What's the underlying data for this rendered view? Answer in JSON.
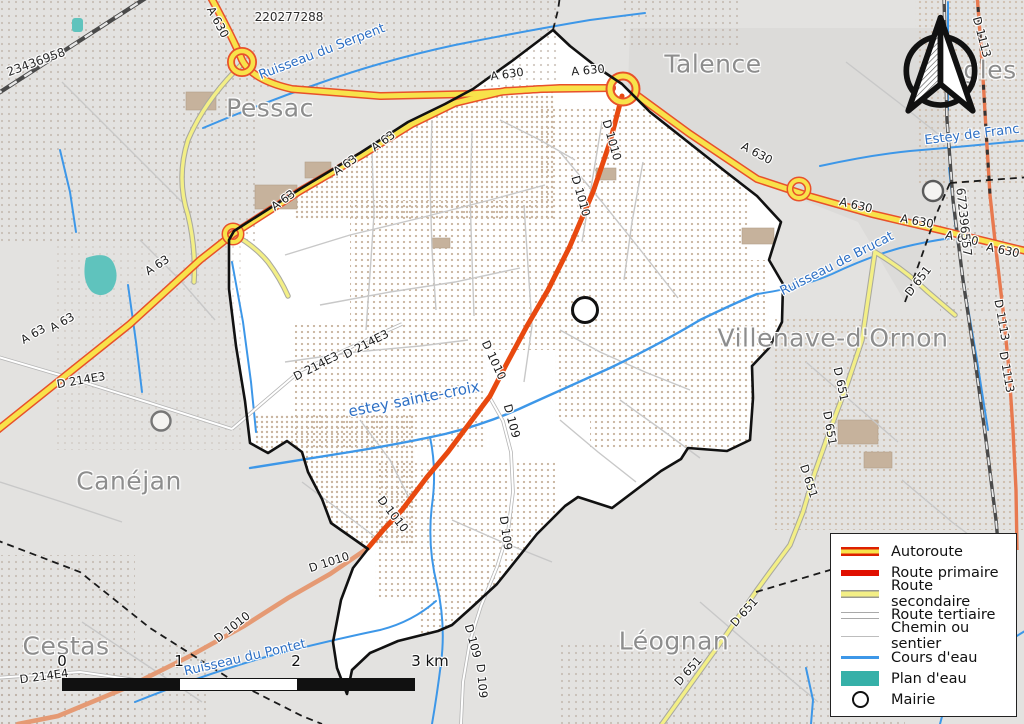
{
  "map": {
    "region_labels": [
      {
        "t": "Pessac",
        "x": 270,
        "y": 108
      },
      {
        "t": "Talence",
        "x": 713,
        "y": 64
      },
      {
        "t": "Villenave-d'Ornon",
        "x": 833,
        "y": 338
      },
      {
        "t": "Canéjan",
        "x": 129,
        "y": 481
      },
      {
        "t": "Cestas",
        "x": 66,
        "y": 646
      },
      {
        "t": "Léognan",
        "x": 674,
        "y": 641
      },
      {
        "t": "gles",
        "x": 990,
        "y": 70
      }
    ],
    "road_labels": [
      {
        "t": "A 630",
        "x": 218,
        "y": 22,
        "r": 62
      },
      {
        "t": "A 630",
        "x": 507,
        "y": 74,
        "r": -8
      },
      {
        "t": "A 630",
        "x": 588,
        "y": 70,
        "r": -5
      },
      {
        "t": "A 630",
        "x": 757,
        "y": 153,
        "r": 28
      },
      {
        "t": "A 630",
        "x": 856,
        "y": 205,
        "r": 13
      },
      {
        "t": "A 630",
        "x": 917,
        "y": 221,
        "r": 10
      },
      {
        "t": "A 630",
        "x": 962,
        "y": 238,
        "r": 12
      },
      {
        "t": "A 630",
        "x": 1003,
        "y": 250,
        "r": 12
      },
      {
        "t": "A 63",
        "x": 283,
        "y": 200,
        "r": -36
      },
      {
        "t": "A 63",
        "x": 345,
        "y": 165,
        "r": -36
      },
      {
        "t": "A 63",
        "x": 383,
        "y": 141,
        "r": -36
      },
      {
        "t": "A 63",
        "x": 157,
        "y": 265,
        "r": -33
      },
      {
        "t": "A 63",
        "x": 33,
        "y": 334,
        "r": -30
      },
      {
        "t": "A 63",
        "x": 62,
        "y": 322,
        "r": -30
      },
      {
        "t": "D 1010",
        "x": 612,
        "y": 140,
        "r": 74
      },
      {
        "t": "D 1010",
        "x": 581,
        "y": 196,
        "r": 74
      },
      {
        "t": "D 1010",
        "x": 494,
        "y": 360,
        "r": 65
      },
      {
        "t": "D 1010",
        "x": 393,
        "y": 514,
        "r": 52
      },
      {
        "t": "D 1010",
        "x": 329,
        "y": 562,
        "r": -18
      },
      {
        "t": "D 1010",
        "x": 232,
        "y": 627,
        "r": -38
      },
      {
        "t": "D 109",
        "x": 512,
        "y": 421,
        "r": 75
      },
      {
        "t": "D 109",
        "x": 506,
        "y": 533,
        "r": 82
      },
      {
        "t": "D 109",
        "x": 473,
        "y": 641,
        "r": 75
      },
      {
        "t": "D 109",
        "x": 482,
        "y": 681,
        "r": 85
      },
      {
        "t": "D 651",
        "x": 841,
        "y": 384,
        "r": 78
      },
      {
        "t": "D 651",
        "x": 830,
        "y": 428,
        "r": 80
      },
      {
        "t": "D 651",
        "x": 809,
        "y": 481,
        "r": 72
      },
      {
        "t": "D 651",
        "x": 918,
        "y": 281,
        "r": -52
      },
      {
        "t": "D 651",
        "x": 744,
        "y": 612,
        "r": -48
      },
      {
        "t": "D 651",
        "x": 688,
        "y": 671,
        "r": -48
      },
      {
        "t": "D 1113",
        "x": 982,
        "y": 37,
        "r": 75
      },
      {
        "t": "D 1113",
        "x": 1002,
        "y": 320,
        "r": 80
      },
      {
        "t": "D 1113",
        "x": 1007,
        "y": 372,
        "r": 80
      },
      {
        "t": "D 214E3",
        "x": 81,
        "y": 380,
        "r": -10
      },
      {
        "t": "D 214E3",
        "x": 316,
        "y": 366,
        "r": -27
      },
      {
        "t": "D 214E3",
        "x": 366,
        "y": 344,
        "r": -27
      },
      {
        "t": "D 214E4",
        "x": 44,
        "y": 676,
        "r": -8
      }
    ],
    "water_labels": [
      {
        "t": "Ruisseau du Serpent",
        "x": 322,
        "y": 52,
        "r": -21
      },
      {
        "t": "Estey de Franc",
        "x": 972,
        "y": 135,
        "r": -7
      },
      {
        "t": "Ruisseau de Brucat",
        "x": 837,
        "y": 264,
        "r": -27
      },
      {
        "t": "estey sainte-croix",
        "x": 414,
        "y": 399,
        "r": -11,
        "s": 15
      },
      {
        "t": "Ruisseau du Pontet",
        "x": 245,
        "y": 658,
        "r": -13
      }
    ],
    "ref_labels": [
      {
        "t": "220277288",
        "x": 289,
        "y": 17
      },
      {
        "t": "23436958",
        "x": 36,
        "y": 62,
        "r": -20
      },
      {
        "t": "672396557",
        "x": 964,
        "y": 222,
        "r": 84
      }
    ]
  },
  "legend": {
    "items": [
      {
        "key": "autoroute",
        "label": "Autoroute"
      },
      {
        "key": "primaire",
        "label": "Route primaire"
      },
      {
        "key": "secondaire",
        "label": "Route secondaire"
      },
      {
        "key": "tertiaire",
        "label": "Route tertiaire"
      },
      {
        "key": "chemin",
        "label": "Chemin ou sentier"
      },
      {
        "key": "cours",
        "label": "Cours d'eau"
      },
      {
        "key": "plan",
        "label": "Plan d'eau"
      },
      {
        "key": "mairie",
        "label": "Mairie"
      }
    ]
  },
  "scalebar": {
    "ticks": [
      {
        "t": "0",
        "x": 8
      },
      {
        "t": "1",
        "x": 125
      },
      {
        "t": "2",
        "x": 242
      },
      {
        "t": "3 km",
        "x": 376
      }
    ]
  },
  "colors": {
    "autoroute_fill": "#f8e24a",
    "autoroute_casing": "#e8512a",
    "route_primaire": "#e8490f",
    "route_primaire_muted": "#e59a74",
    "route_secondaire": "#f3ef86",
    "cours_eau": "#3d97e8",
    "plan_eau": "#35b0a8",
    "city_label": "#8d8d8d",
    "water_label": "#2d6fc4",
    "commune_fill": "#ffffff",
    "outside_fill": "#e3e2e0"
  }
}
